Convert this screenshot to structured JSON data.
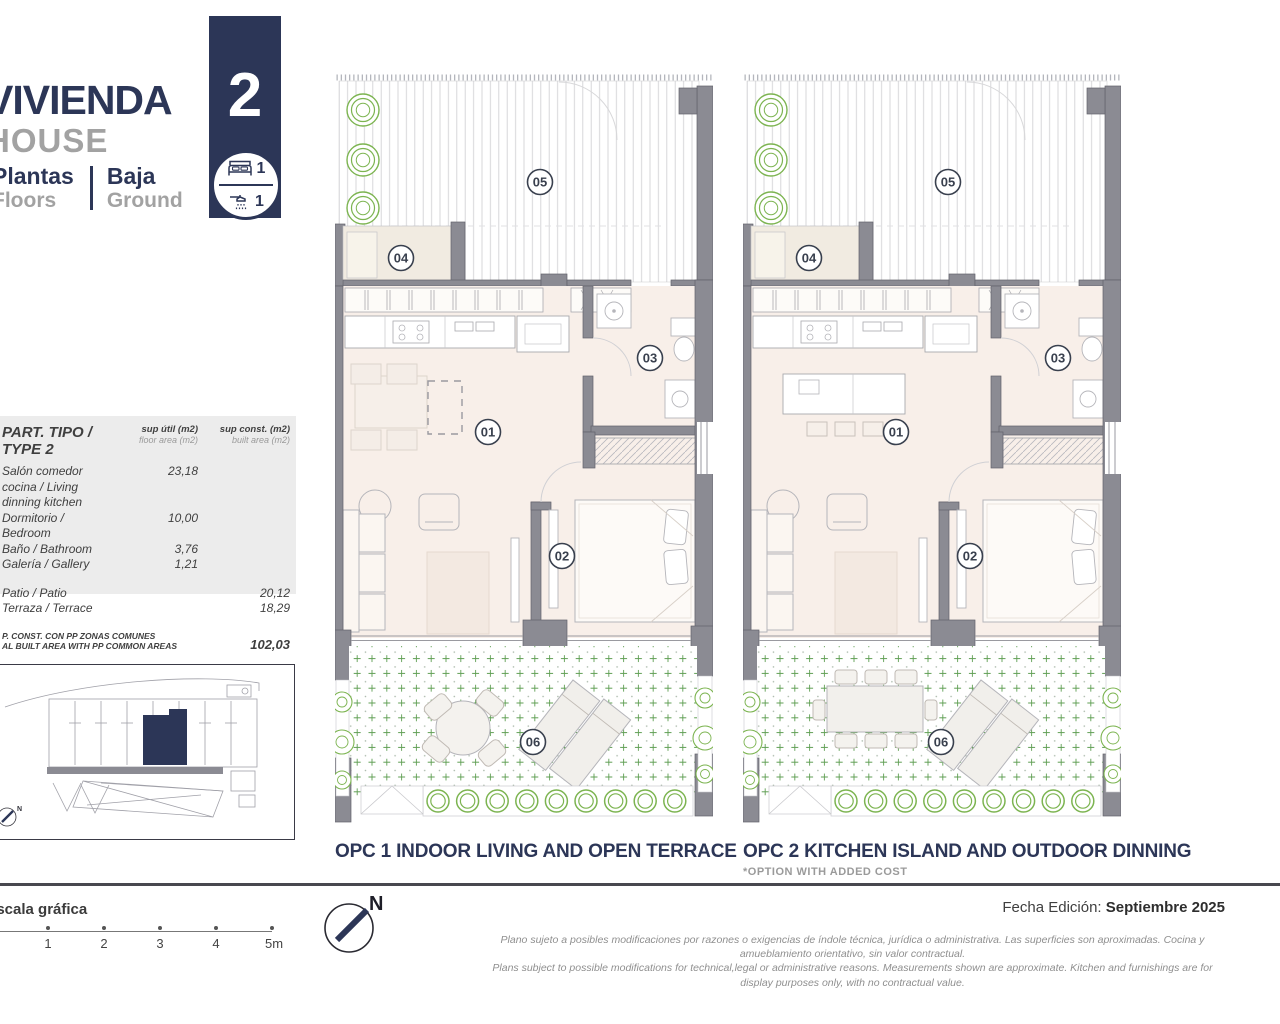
{
  "header": {
    "title_es": "VIVIENDA",
    "title_en": "HOUSE",
    "floors_label_es": "Plantas",
    "floors_label_en": "Floors",
    "floors_value_es": "Baja",
    "floors_value_en": "Ground",
    "unit_number": "2",
    "bedrooms_count": "1",
    "bathrooms_count": "1"
  },
  "area_table": {
    "title": "PART. TIPO / TYPE 2",
    "col1_title": "sup útil (m2)",
    "col1_sub": "floor area (m2)",
    "col2_title": "sup const. (m2)",
    "col2_sub": "built area (m2)",
    "rows": [
      {
        "label": "Salón comedor cocina / Living dinning kitchen",
        "col1": "23,18",
        "col2": ""
      },
      {
        "label": "Dormitorio / Bedroom",
        "col1": "10,00",
        "col2": ""
      },
      {
        "label": "Baño / Bathroom",
        "col1": "3,76",
        "col2": ""
      },
      {
        "label": "Galería / Gallery",
        "col1": "1,21",
        "col2": ""
      },
      {
        "label": "Patio / Patio",
        "col1": "",
        "col2": "20,12"
      },
      {
        "label": "Terraza / Terrace",
        "col1": "",
        "col2": "18,29"
      }
    ],
    "total_label_line1": "P. CONST. CON PP ZONAS COMUNES",
    "total_label_line2": "AL BUILT AREA WITH PP COMMON AREAS",
    "total_value": "102,03"
  },
  "plans": {
    "room_labels": [
      "01",
      "02",
      "03",
      "04",
      "05",
      "06"
    ],
    "opc1_caption": "OPC 1 INDOOR LIVING AND OPEN TERRACE",
    "opc2_caption": "OPC 2 KITCHEN ISLAND AND OUTDOOR DINNING",
    "opc2_note": "*OPTION WITH ADDED COST"
  },
  "footer": {
    "scale_label": "escala gráfica",
    "scale_ticks": [
      "1",
      "2",
      "3",
      "4",
      "5m"
    ],
    "north_label": "N",
    "edition_label": "Fecha Edición:",
    "edition_value": "Septiembre 2025",
    "disclaimer_es": "Plano sujeto a posibles modificaciones por razones o exigencias de índole técnica,  jurídica o administrativa. Las superficies son aproximadas. Cocina y amueblamiento orientativo, sin valor contractual.",
    "disclaimer_en": "Plans subject to possible modifications for technical,legal or administrative reasons. Measurements shown are approximate. Kitchen and furnishings are for display purposes only, with no contractual value."
  },
  "colors": {
    "navy": "#2c3657",
    "wall": "#8b8b93",
    "wall_edge": "#62626b",
    "floor": "#f8efe9",
    "room04_floor": "#f1ebe1",
    "green": "#7cb450",
    "cross_green": "#5f9e53",
    "furn": "#b5b5ba",
    "faint": "#ddd4cc"
  }
}
